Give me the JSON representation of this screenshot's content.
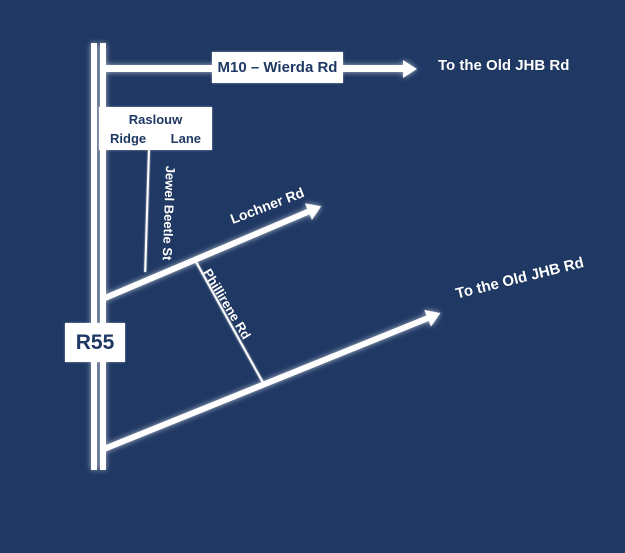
{
  "colors": {
    "background": "#1f3864",
    "road": "#ffffff",
    "sign_background": "#ffffff",
    "sign_text": "#1f3864",
    "road_label_text": "#ffffff"
  },
  "signs": {
    "m10": {
      "label": "M10 – Wierda Rd"
    },
    "raslouw": {
      "line1": "Raslouw",
      "line2_left": "Ridge",
      "line2_right": "Lane"
    },
    "r55": {
      "label": "R55"
    }
  },
  "road_labels": {
    "to_old_jhb_top": "To the Old JHB Rd",
    "jewel_beetle": "Jewel Beetle St",
    "lochner": "Lochner Rd",
    "phillirene": "Phillirene Rd",
    "to_old_jhb_diagonal": "To the Old JHB Rd"
  }
}
